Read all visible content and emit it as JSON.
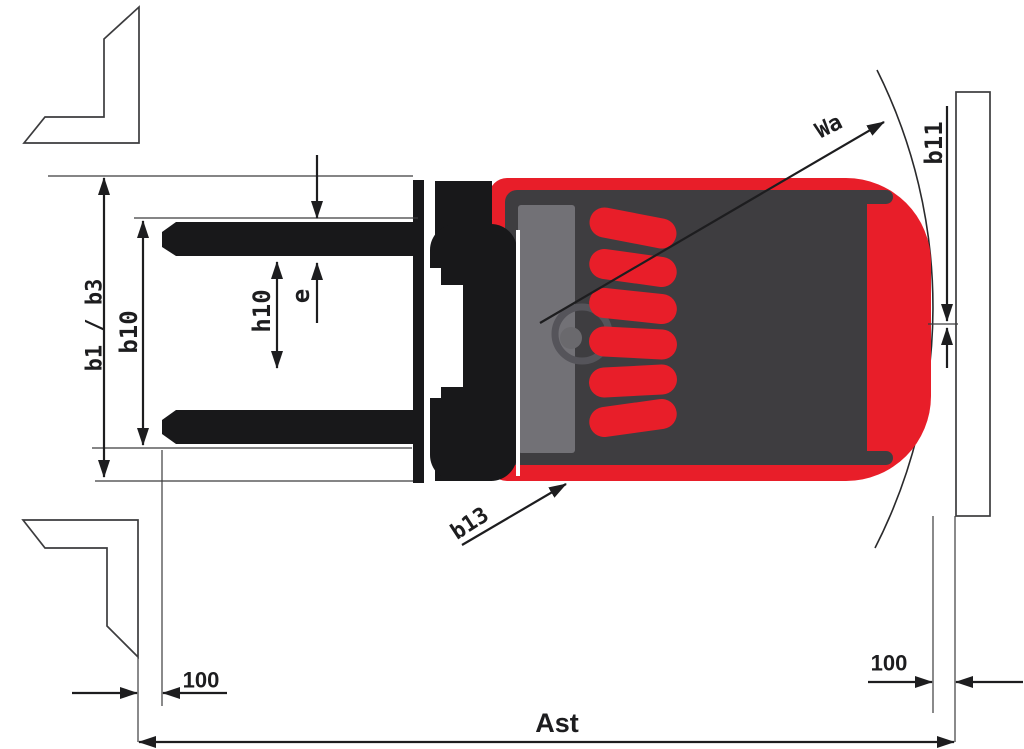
{
  "diagram": {
    "type": "forklift-aisle-top-view-dimension-drawing",
    "dimension_labels": {
      "b1_b3": "b1 / b3",
      "b10": "b10",
      "h10": "h10",
      "e": "e",
      "wa": "Wa",
      "b11": "b11",
      "b13": "b13",
      "clearance_left": "100",
      "clearance_right": "100",
      "ast": "Ast"
    },
    "colors": {
      "truck_red": "#e81e29",
      "chassis_gray": "#3e3d40",
      "panel_gray": "#727176",
      "steering_gray": "#55545a",
      "wheel_black": "#18181a",
      "line_black": "#1d1d1f"
    }
  }
}
